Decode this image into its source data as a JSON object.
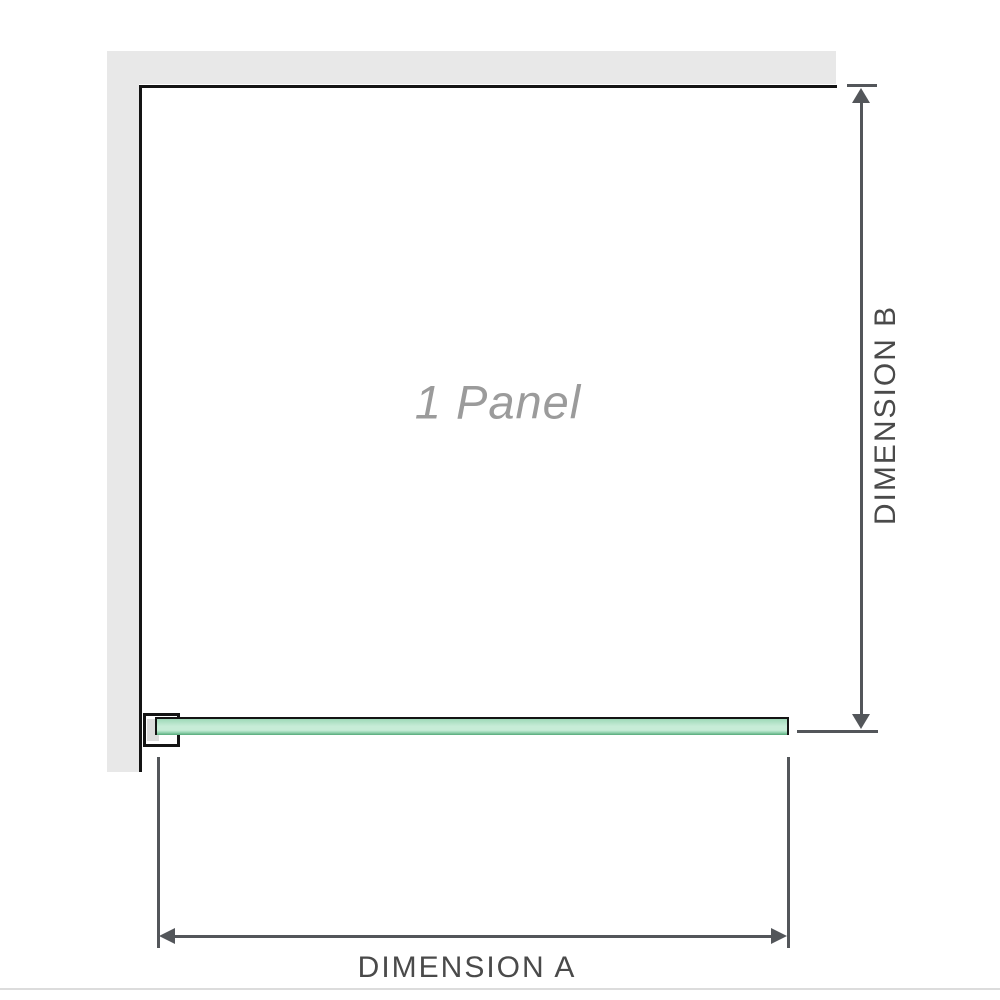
{
  "diagram": {
    "panel_label": "1 Panel",
    "dimension_a_label": "DIMENSION A",
    "dimension_b_label": "DIMENSION B"
  },
  "colors": {
    "wall": "#e8e8e8",
    "panel_outline": "#141414",
    "glass_light": "#c7ecd7",
    "glass_mid": "#9ed9b8",
    "glass_dark": "#55aa79",
    "dimension_line": "#53565a",
    "dimension_text": "#4a4a4a",
    "watermark_text": "#9b9b9b",
    "divider": "#dcdcdc"
  }
}
